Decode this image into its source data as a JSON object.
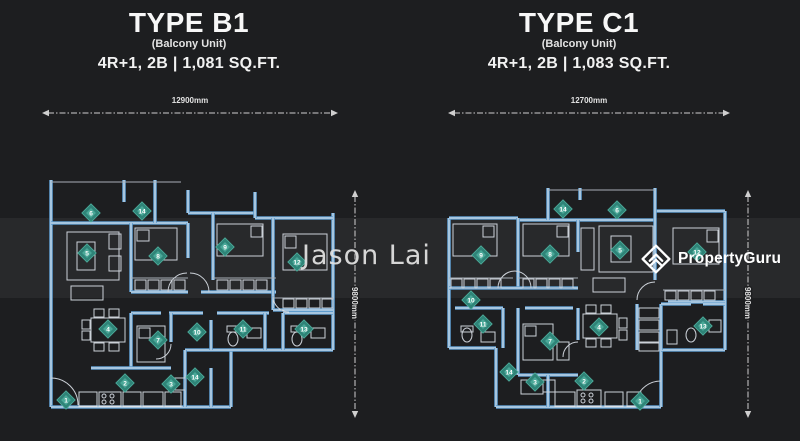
{
  "watermark": {
    "text": "Jason Lai"
  },
  "brand": {
    "name": "PropertyGuru"
  },
  "colors": {
    "wall_blue": "#5f9ccd",
    "marker_teal": "#2f8478",
    "marker_teal_light": "#4fae9d",
    "background": "#1d1e20"
  },
  "units": [
    {
      "title": "TYPE B1",
      "subtitle": "(Balcony Unit)",
      "spec": "4R+1, 2B | 1,081 SQ.FT.",
      "width_label": "12900mm",
      "height_label": "9800mm",
      "plan": {
        "walls": [
          [
            20,
            0,
            20,
            227
          ],
          [
            20,
            227,
            200,
            227
          ],
          [
            200,
            170,
            200,
            227
          ],
          [
            154,
            170,
            302,
            170
          ],
          [
            302,
            33,
            302,
            170
          ],
          [
            20,
            43,
            157,
            43
          ],
          [
            157,
            33,
            224,
            33
          ],
          [
            224,
            38,
            302,
            38
          ],
          [
            93,
            0,
            93,
            22
          ],
          [
            124,
            0,
            124,
            43
          ],
          [
            157,
            10,
            157,
            33
          ],
          [
            224,
            12,
            224,
            38
          ],
          [
            100,
            43,
            100,
            112
          ],
          [
            100,
            112,
            157,
            112
          ],
          [
            157,
            43,
            157,
            78
          ],
          [
            182,
            33,
            182,
            100
          ],
          [
            170,
            112,
            245,
            112
          ],
          [
            242,
            38,
            242,
            130
          ],
          [
            242,
            130,
            302,
            130
          ],
          [
            100,
            133,
            130,
            133
          ],
          [
            138,
            133,
            172,
            133
          ],
          [
            186,
            133,
            238,
            133
          ],
          [
            252,
            133,
            302,
            133
          ],
          [
            100,
            133,
            100,
            188
          ],
          [
            60,
            188,
            140,
            188
          ],
          [
            140,
            133,
            140,
            162
          ],
          [
            180,
            140,
            180,
            170
          ],
          [
            234,
            133,
            234,
            170
          ],
          [
            252,
            133,
            252,
            170
          ],
          [
            154,
            170,
            154,
            227
          ],
          [
            180,
            188,
            180,
            227
          ]
        ],
        "thin": [
          [
            20,
            2,
            150,
            2
          ],
          [
            100,
            98,
            157,
            98
          ],
          [
            182,
            98,
            245,
            98
          ],
          [
            242,
            118,
            302,
            118
          ]
        ],
        "rects": [
          [
            36,
            52,
            52,
            48
          ],
          [
            46,
            62,
            18,
            28
          ],
          [
            78,
            54,
            12,
            15
          ],
          [
            78,
            76,
            12,
            15
          ],
          [
            40,
            106,
            32,
            14
          ],
          [
            104,
            48,
            42,
            32
          ],
          [
            106,
            50,
            12,
            11
          ],
          [
            104,
            100,
            11,
            10
          ],
          [
            117,
            100,
            11,
            10
          ],
          [
            130,
            100,
            11,
            10
          ],
          [
            143,
            100,
            11,
            10
          ],
          [
            186,
            44,
            46,
            32
          ],
          [
            220,
            46,
            11,
            11
          ],
          [
            186,
            100,
            11,
            10
          ],
          [
            199,
            100,
            11,
            10
          ],
          [
            212,
            100,
            11,
            10
          ],
          [
            225,
            100,
            11,
            10
          ],
          [
            252,
            54,
            44,
            36
          ],
          [
            254,
            56,
            11,
            12
          ],
          [
            252,
            119,
            11,
            9
          ],
          [
            265,
            119,
            11,
            9
          ],
          [
            278,
            119,
            11,
            9
          ],
          [
            291,
            119,
            11,
            9
          ],
          [
            60,
            138,
            34,
            24
          ],
          [
            63,
            129,
            10,
            8
          ],
          [
            78,
            129,
            10,
            8
          ],
          [
            63,
            163,
            10,
            8
          ],
          [
            78,
            163,
            10,
            8
          ],
          [
            51,
            140,
            8,
            9
          ],
          [
            51,
            151,
            8,
            9
          ],
          [
            106,
            146,
            28,
            36
          ],
          [
            108,
            148,
            11,
            10
          ],
          [
            216,
            148,
            14,
            10
          ],
          [
            196,
            146,
            12,
            6
          ],
          [
            280,
            148,
            14,
            10
          ],
          [
            260,
            146,
            12,
            6
          ],
          [
            48,
            212,
            18,
            14
          ],
          [
            68,
            212,
            22,
            14
          ],
          [
            92,
            212,
            18,
            14
          ],
          [
            112,
            212,
            20,
            14
          ],
          [
            134,
            212,
            16,
            14
          ],
          [
            142,
            198,
            12,
            12
          ]
        ],
        "circles": [
          [
            73,
            216
          ],
          [
            81,
            216
          ],
          [
            73,
            222
          ],
          [
            81,
            222
          ]
        ],
        "ellipses": [
          [
            202,
            159,
            5,
            7
          ],
          [
            266,
            159,
            5,
            7
          ]
        ],
        "arcs": [
          "M20,198 A27,27 0 0 1 47,225",
          "M137,112 A19,19 0 0 1 156,93",
          "M178,112 A19,19 0 0 0 159,93",
          "M242,116 A16,16 0 0 0 258,132",
          "M140,164 A15,15 0 0 1 125,179"
        ],
        "markers": [
          [
            "6",
            60,
            33
          ],
          [
            "14",
            111,
            31
          ],
          [
            "5",
            56,
            73
          ],
          [
            "8",
            127,
            76
          ],
          [
            "9",
            194,
            67
          ],
          [
            "12",
            266,
            82
          ],
          [
            "4",
            77,
            149
          ],
          [
            "7",
            127,
            160
          ],
          [
            "10",
            166,
            152
          ],
          [
            "11",
            212,
            149
          ],
          [
            "13",
            273,
            149
          ],
          [
            "2",
            94,
            203
          ],
          [
            "3",
            140,
            204
          ],
          [
            "14",
            164,
            197
          ],
          [
            "1",
            35,
            220
          ]
        ]
      }
    },
    {
      "title": "TYPE C1",
      "subtitle": "(Balcony Unit)",
      "spec": "4R+1, 2B | 1,083 SQ.FT.",
      "width_label": "12700mm",
      "height_label": "9800mm",
      "plan": {
        "walls": [
          [
            26,
            38,
            26,
            168
          ],
          [
            26,
            168,
            73,
            168
          ],
          [
            73,
            168,
            73,
            227
          ],
          [
            73,
            227,
            238,
            227
          ],
          [
            238,
            170,
            238,
            227
          ],
          [
            238,
            170,
            302,
            170
          ],
          [
            302,
            31,
            302,
            170
          ],
          [
            26,
            38,
            95,
            38
          ],
          [
            95,
            40,
            232,
            40
          ],
          [
            232,
            31,
            302,
            31
          ],
          [
            125,
            8,
            125,
            40
          ],
          [
            157,
            8,
            157,
            20
          ],
          [
            232,
            8,
            232,
            31
          ],
          [
            95,
            38,
            95,
            108
          ],
          [
            26,
            108,
            95,
            108
          ],
          [
            95,
            108,
            155,
            108
          ],
          [
            155,
            40,
            155,
            72
          ],
          [
            232,
            31,
            232,
            100
          ],
          [
            245,
            122,
            302,
            122
          ],
          [
            32,
            128,
            80,
            128
          ],
          [
            80,
            128,
            80,
            168
          ],
          [
            95,
            128,
            95,
            195
          ],
          [
            95,
            195,
            155,
            195
          ],
          [
            155,
            128,
            155,
            160
          ],
          [
            102,
            128,
            150,
            128
          ],
          [
            214,
            124,
            214,
            170
          ],
          [
            238,
            124,
            238,
            170
          ],
          [
            238,
            124,
            268,
            124
          ],
          [
            280,
            124,
            302,
            124
          ],
          [
            125,
            195,
            125,
            227
          ]
        ],
        "thin": [
          [
            125,
            10,
            232,
            10
          ],
          [
            26,
            98,
            90,
            98
          ],
          [
            95,
            98,
            155,
            98
          ],
          [
            240,
            110,
            302,
            110
          ]
        ],
        "rects": [
          [
            30,
            44,
            44,
            32
          ],
          [
            60,
            46,
            11,
            11
          ],
          [
            28,
            99,
            11,
            9
          ],
          [
            41,
            99,
            11,
            9
          ],
          [
            54,
            99,
            11,
            9
          ],
          [
            67,
            99,
            11,
            9
          ],
          [
            100,
            44,
            46,
            32
          ],
          [
            134,
            46,
            11,
            11
          ],
          [
            100,
            99,
            11,
            9
          ],
          [
            113,
            99,
            11,
            9
          ],
          [
            126,
            99,
            11,
            9
          ],
          [
            139,
            99,
            11,
            9
          ],
          [
            158,
            48,
            13,
            42
          ],
          [
            176,
            46,
            54,
            46
          ],
          [
            188,
            56,
            20,
            26
          ],
          [
            170,
            98,
            32,
            14
          ],
          [
            250,
            48,
            46,
            36
          ],
          [
            284,
            50,
            11,
            12
          ],
          [
            242,
            111,
            11,
            9
          ],
          [
            255,
            111,
            11,
            9
          ],
          [
            268,
            111,
            11,
            9
          ],
          [
            281,
            111,
            11,
            9
          ],
          [
            38,
            146,
            12,
            6
          ],
          [
            58,
            152,
            14,
            10
          ],
          [
            100,
            144,
            30,
            36
          ],
          [
            102,
            146,
            11,
            10
          ],
          [
            134,
            162,
            12,
            18
          ],
          [
            160,
            134,
            34,
            24
          ],
          [
            163,
            125,
            10,
            8
          ],
          [
            178,
            125,
            10,
            8
          ],
          [
            163,
            159,
            10,
            8
          ],
          [
            178,
            159,
            10,
            8
          ],
          [
            196,
            138,
            8,
            10
          ],
          [
            196,
            150,
            8,
            10
          ],
          [
            216,
            128,
            20,
            10
          ],
          [
            216,
            140,
            20,
            10
          ],
          [
            216,
            152,
            20,
            10
          ],
          [
            216,
            163,
            20,
            8
          ],
          [
            286,
            140,
            12,
            12
          ],
          [
            244,
            150,
            10,
            14
          ],
          [
            132,
            212,
            20,
            14
          ],
          [
            154,
            210,
            24,
            16
          ],
          [
            182,
            212,
            18,
            14
          ],
          [
            204,
            212,
            14,
            14
          ],
          [
            120,
            200,
            12,
            12
          ],
          [
            98,
            200,
            22,
            14
          ]
        ],
        "circles": [
          [
            160,
            215
          ],
          [
            168,
            215
          ],
          [
            160,
            221
          ],
          [
            168,
            221
          ]
        ],
        "ellipses": [
          [
            44,
            155,
            5,
            7
          ],
          [
            268,
            155,
            5,
            7
          ]
        ],
        "arcs": [
          "M212,227 A26,26 0 0 1 238,201",
          "M75,108 A17,17 0 0 1 92,91",
          "M108,108 A17,17 0 0 0 92,91",
          "M232,102 A18,18 0 0 0 214,120",
          "M155,162 A15,15 0 0 0 140,177"
        ],
        "markers": [
          [
            "14",
            140,
            29
          ],
          [
            "6",
            194,
            30
          ],
          [
            "9",
            58,
            75
          ],
          [
            "8",
            127,
            74
          ],
          [
            "5",
            197,
            70
          ],
          [
            "12",
            274,
            72
          ],
          [
            "10",
            48,
            120
          ],
          [
            "11",
            60,
            144
          ],
          [
            "7",
            127,
            161
          ],
          [
            "4",
            176,
            147
          ],
          [
            "13",
            280,
            146
          ],
          [
            "14",
            86,
            192
          ],
          [
            "3",
            112,
            202
          ],
          [
            "2",
            161,
            201
          ],
          [
            "1",
            217,
            221
          ]
        ]
      }
    }
  ]
}
